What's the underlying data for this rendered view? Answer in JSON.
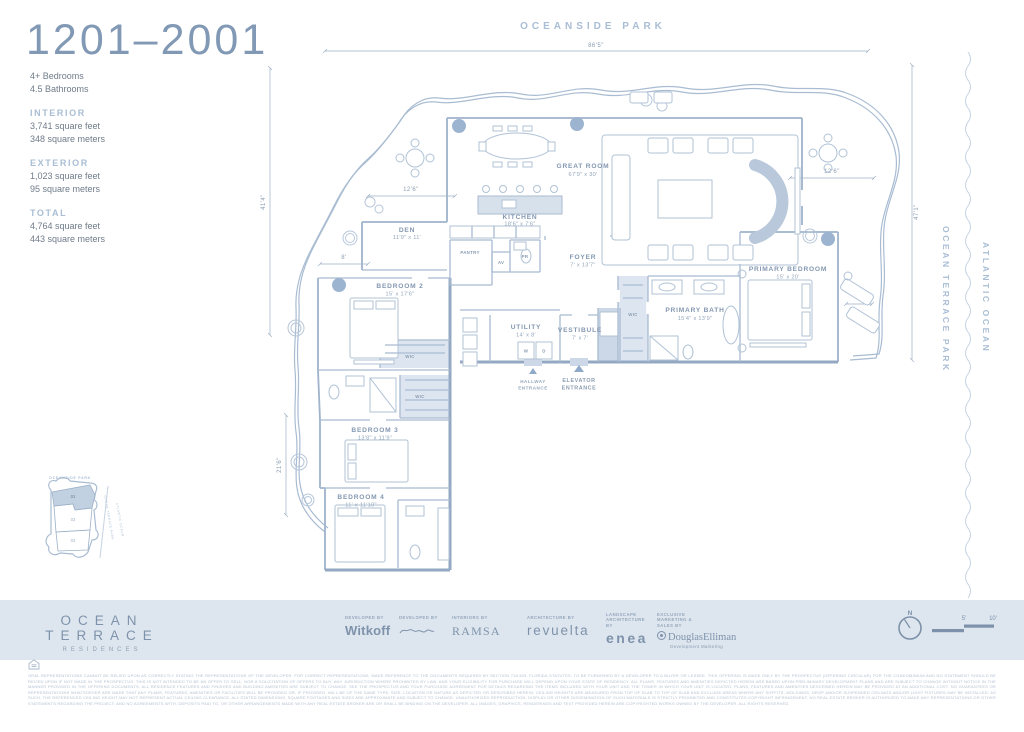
{
  "colors": {
    "accent": "#8299b5",
    "light_label": "#a9bdd4",
    "footer_bg": "#dde5ee",
    "plan_line": "#a9bcd2"
  },
  "sidebar": {
    "unit_range": "1201–2001",
    "bedrooms": "4+ Bedrooms",
    "bathrooms": "4.5 Bathrooms",
    "interior_label": "INTERIOR",
    "interior_sqft": "3,741 square feet",
    "interior_sqm": "348 square meters",
    "exterior_label": "EXTERIOR",
    "exterior_sqft": "1,023 square feet",
    "exterior_sqm": "95 square meters",
    "total_label": "TOTAL",
    "total_sqft": "4,764 square feet",
    "total_sqm": "443 square meters"
  },
  "plan": {
    "park_label": "OCEANSIDE PARK",
    "side_labels": {
      "ocean_terrace_park": "OCEAN TERRACE PARK",
      "atlantic_ocean": "ATLANTIC OCEAN"
    },
    "dims": {
      "top": "86'5\"",
      "left_upper": "41'4\"",
      "left_lower": "21'6\"",
      "den_terrace": "12'6\"",
      "bedroom2_terrace": "8'",
      "right_terrace": "12'6\"",
      "primary_terrace": "8'",
      "right_side": "47'1\""
    },
    "rooms": {
      "great_room": {
        "name": "GREAT ROOM",
        "dims": "67'9\" x 30'"
      },
      "kitchen": {
        "name": "KITCHEN",
        "dims": "18'6\" x 7'6\""
      },
      "den": {
        "name": "DEN",
        "dims": "11'9\" x 11'"
      },
      "pantry": {
        "name": "PANTRY"
      },
      "pr": {
        "name": "PR"
      },
      "av": {
        "name": "AV"
      },
      "foyer": {
        "name": "FOYER",
        "dims": "7' x 13'7\""
      },
      "utility": {
        "name": "UTILITY",
        "dims": "14' x 8'"
      },
      "vestibule": {
        "name": "VESTIBULE",
        "dims": "7' x 7'"
      },
      "wic": {
        "name": "WIC"
      },
      "primary_bedroom": {
        "name": "PRIMARY BEDROOM",
        "dims": "15' x 20'"
      },
      "primary_bath": {
        "name": "PRIMARY BATH",
        "dims": "15'4\" x 13'9\""
      },
      "bedroom2": {
        "name": "BEDROOM 2",
        "dims": "15' x 17'6\""
      },
      "bedroom3": {
        "name": "BEDROOM 3",
        "dims": "13'8\" x 11'9\""
      },
      "bedroom4": {
        "name": "BEDROOM 4",
        "dims": "11' x 11'10\""
      }
    },
    "labels": {
      "hallway_entrance": [
        "HALLWAY",
        "ENTRANCE"
      ],
      "elevator_entrance": [
        "ELEVATOR",
        "ENTRANCE"
      ],
      "washer": "W",
      "dryer": "D"
    }
  },
  "keymap": {
    "park": "OCEANSIDE PARK",
    "units": [
      "01",
      "02",
      "03"
    ],
    "ocean_terrace_park": "OCEAN TERRACE PARK",
    "atlantic_ocean": "ATLANTIC OCEAN"
  },
  "footer": {
    "brand_line1": "OCEAN TERRACE",
    "brand_line2": "RESIDENCES",
    "credits": [
      {
        "caption": "DEVELOPED BY",
        "name": "Witkoff"
      },
      {
        "caption": "DEVELOPED BY",
        "name": ""
      },
      {
        "caption": "INTERIORS BY",
        "name": "RAMSA"
      },
      {
        "caption": "ARCHITECTURE BY",
        "name": "revuelta"
      },
      {
        "caption": "LANDSCAPE ARCHITECTURE BY",
        "name": "enea"
      },
      {
        "caption": "EXCLUSIVE MARKETING & SALES BY",
        "name": "DouglasElliman",
        "sub": "Development Marketing"
      }
    ],
    "compass_north": "N",
    "scale_labels": [
      "5'",
      "10'"
    ]
  },
  "legal": {
    "text": "ORAL REPRESENTATIONS CANNOT BE RELIED UPON AS CORRECTLY STATING THE REPRESENTATIONS OF THE DEVELOPER. FOR CORRECT REPRESENTATIONS, MAKE REFERENCE TO THE DOCUMENTS REQUIRED BY SECTION 718.503, FLORIDA STATUTES, TO BE FURNISHED BY A DEVELOPER TO A BUYER OR LESSEE. THIS OFFERING IS MADE ONLY BY THE PROSPECTUS (OFFERING CIRCULAR) FOR THE CONDOMINIUM AND NO STATEMENT SHOULD BE RELIED UPON IF NOT MADE IN THE PROSPECTUS. THIS IS NOT INTENDED TO BE AN OFFER TO SELL, NOR A SOLICITATION OF OFFERS TO BUY, ANY JURISDICTION WHERE PROHIBITED BY LAW, AND YOUR ELIGIBILITY FOR PURCHASE WILL DEPEND UPON YOUR STATE OF RESIDENCY. ALL PLANS, FEATURES AND AMENITIES DEPICTED HEREIN ARE BASED UPON PRELIMINARY DEVELOPMENT PLANS AND ARE SUBJECT TO CHANGE WITHOUT NOTICE IN THE MANNER PROVIDED IN THE OFFERING DOCUMENTS. ALL RESIDENCE FEATURES AND FINISHES AND BUILDING AMENITIES ARE SUBJECT TO CHANGE. SEE THE PROSPECTUS AND YOUR PURCHASE AGREEMENT FOR DETAILS REGARDING THE ITEMS INCLUDED WITH YOUR UNIT AND THE TOWER IN WHICH YOUR UNIT IS LOCATED. PLANS, FEATURES AND AMENITIES DESCRIBED HEREIN MAY BE PROVIDED AT AN ADDITIONAL COST. NO GUARANTEES OR REPRESENTATIONS WHATSOEVER ARE MADE THAT ANY PLANS, FEATURES, AMENITIES OR FACILITIES WILL BE PROVIDED OR, IF PROVIDED, WILL BE OF THE SAME TYPE, SIZE, LOCATION OR NATURE AS DEPICTED OR DESCRIBED HEREIN. CEILING HEIGHTS ARE MEASURED FROM TOP OF SLAB TO TOP OF SLAB AND EXCLUDE AREAS WHERE ANY SOFFITS, MOLDINGS, DROP AND/OR SUSPENDED CEILINGS AND/OR LIGHT FIXTURES MAY BE INSTALLED. AS SUCH, THE REFERENCED CEILING HEIGHT MAY NOT REPRESENT ACTUAL CEILING CLEARANCE. ALL STATED DIMENSIONS, SQUARE FOOTAGES AND SIZES ARE APPROXIMATE AND SUBJECT TO CHANGE. UNAUTHORIZED REPRODUCTION, DISPLAY OR OTHER DISSEMINATION OF SUCH MATERIALS IS STRICTLY PROHIBITED AND CONSTITUTES COPYRIGHT INFRINGEMENT. NO REAL ESTATE BROKER IS AUTHORIZED TO MAKE ANY REPRESENTATIONS OR OTHER STATEMENTS REGARDING THE PROJECT, AND NO AGREEMENTS WITH, DEPOSITS PAID TO, OR OTHER ARRANGEMENTS MADE WITH ANY REAL ESTATE BROKER ARE OR SHALL BE BINDING ON THE DEVELOPER. ALL IMAGES, GRAPHICS, RENDERINGS AND TEXT PROVIDED HEREIN ARE COPYRIGHTED WORKS OWNED BY THE DEVELOPER. ALL RIGHTS RESERVED."
  }
}
